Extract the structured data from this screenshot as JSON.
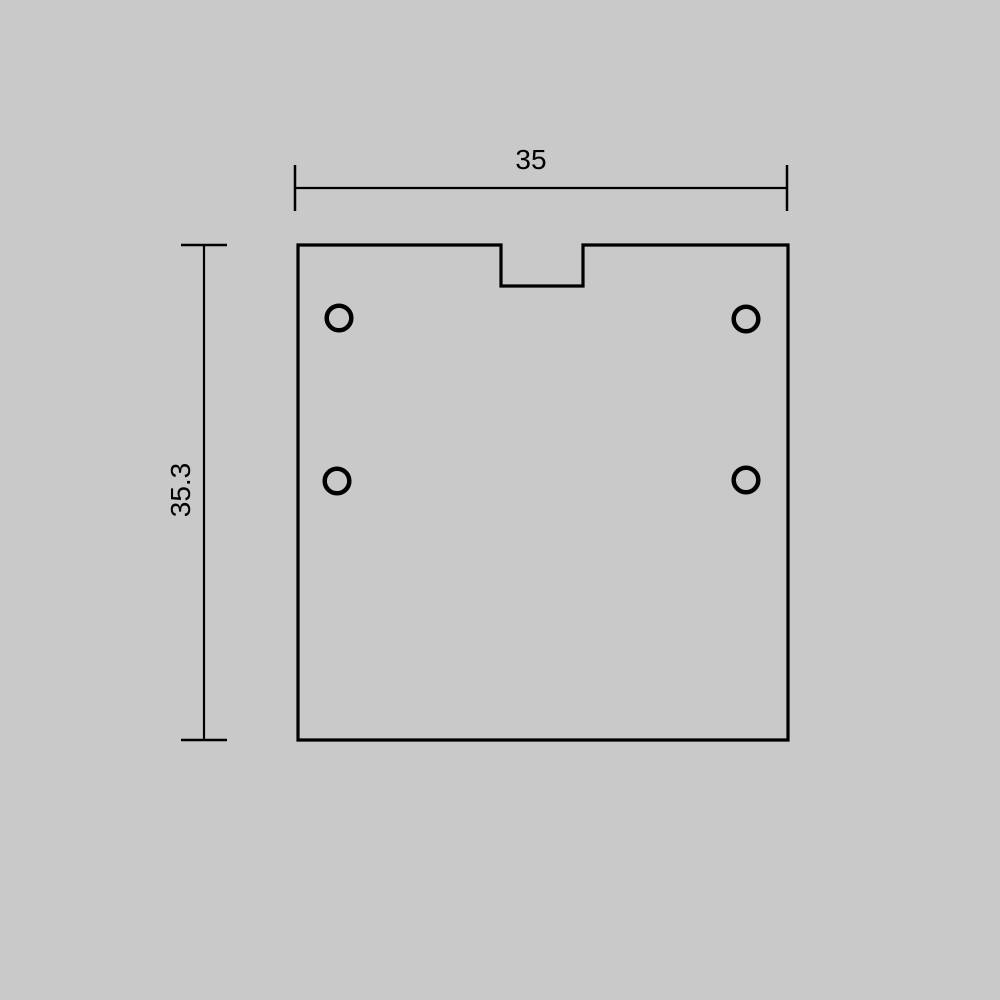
{
  "page": {
    "background_color": "#c9c9c9"
  },
  "drawing": {
    "type": "technical_dimension_drawing",
    "canvas": {
      "width": 1000,
      "height": 1000
    },
    "line_color": "#000000",
    "label_color": "#000000",
    "label_font_size": 28,
    "dimension_stroke_width": 2.2,
    "tick_stroke_width": 2.5,
    "part": {
      "description": "square plate cross-section with centered rectangular notch on top edge and four circular holes",
      "outline_points": "298,245 501,245 501,286 583,286 583,245 788,245 788,740 298,740",
      "outline_stroke_width": 3.2,
      "hole_stroke_width": 4.5,
      "holes": [
        {
          "cx": 339,
          "cy": 318,
          "r": 12.3
        },
        {
          "cx": 746,
          "cy": 319,
          "r": 12.3
        },
        {
          "cx": 337,
          "cy": 481,
          "r": 12.3
        },
        {
          "cx": 746,
          "cy": 480,
          "r": 12.3
        }
      ]
    },
    "dimensions": [
      {
        "id": "width",
        "label": "35",
        "line": [
          295,
          188,
          787,
          188
        ],
        "ticks": [
          [
            295,
            165,
            295,
            211
          ],
          [
            787,
            165,
            787,
            211
          ]
        ],
        "label_pos": [
          531,
          169
        ],
        "label_rotation": 0
      },
      {
        "id": "height",
        "label": "35.3",
        "line": [
          204,
          245,
          204,
          740
        ],
        "ticks": [
          [
            181,
            245,
            227,
            245
          ],
          [
            181,
            740,
            227,
            740
          ]
        ],
        "label_pos": [
          190,
          490
        ],
        "label_rotation": -90
      }
    ]
  }
}
